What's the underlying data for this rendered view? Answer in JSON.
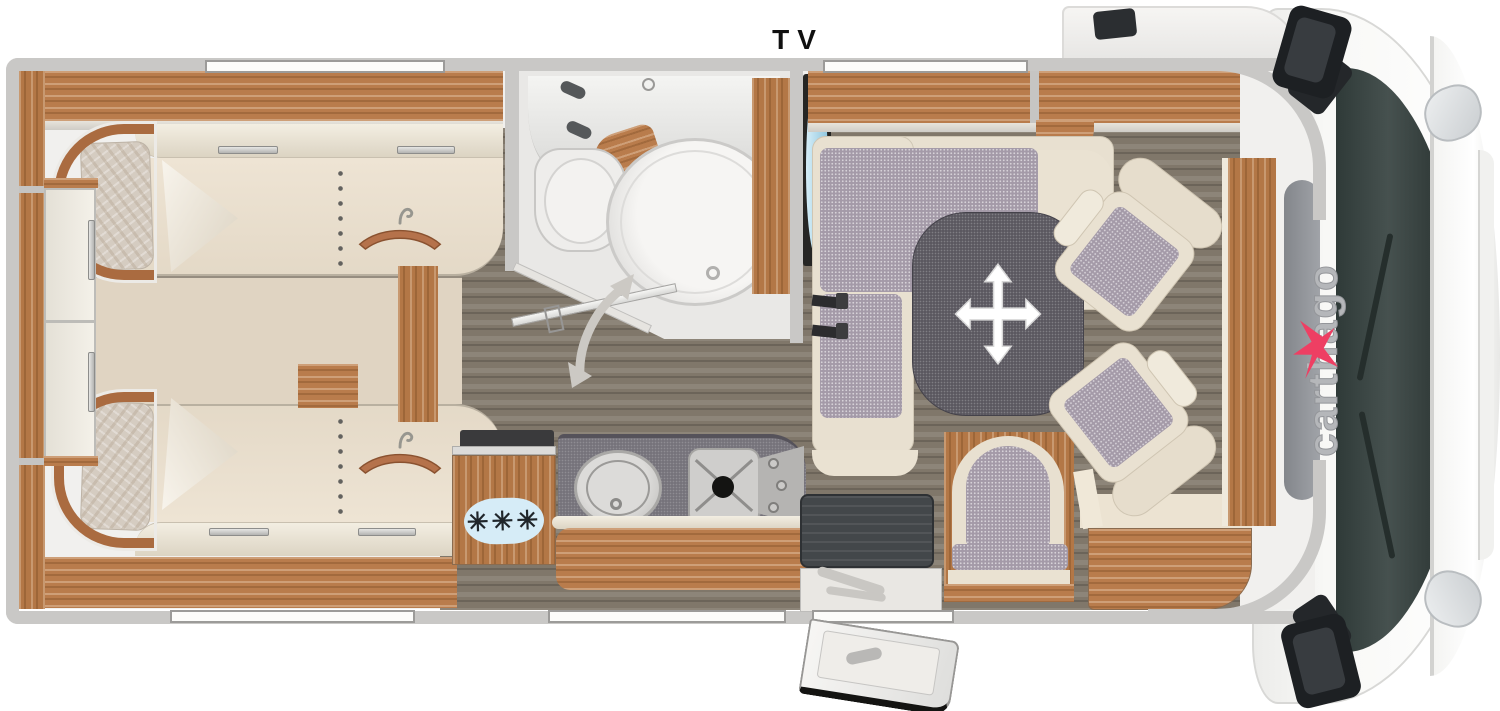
{
  "labels": {
    "tv": "TV",
    "brand": "carthago",
    "freezer": "✳✳✳"
  },
  "icons": {
    "table_move": "four-way-arrow",
    "door_swing": "curved-double-arrow",
    "bed_hanger": "clothes-hanger",
    "freezer_badge": "snowflake-asterisks",
    "tv_screen": "flatscreen-side-view",
    "brand_mark": "carthago-swallow"
  },
  "palette": {
    "wall": "#c9c8c6",
    "wood": "#b97c4c",
    "upholstery": "#e8e0d0",
    "cushion_pattern": "#a49aa8",
    "table": "#5b5860",
    "floor": "#80776a",
    "carpet": "#e0d4c2",
    "tv_screen": "#a9d7eb",
    "brand_pink": "#ee3f63",
    "brand_gray": "#b5b7ba",
    "freezer_badge": "#d6ecf7",
    "windshield": "#36413f",
    "entry_step": "#43474a"
  }
}
